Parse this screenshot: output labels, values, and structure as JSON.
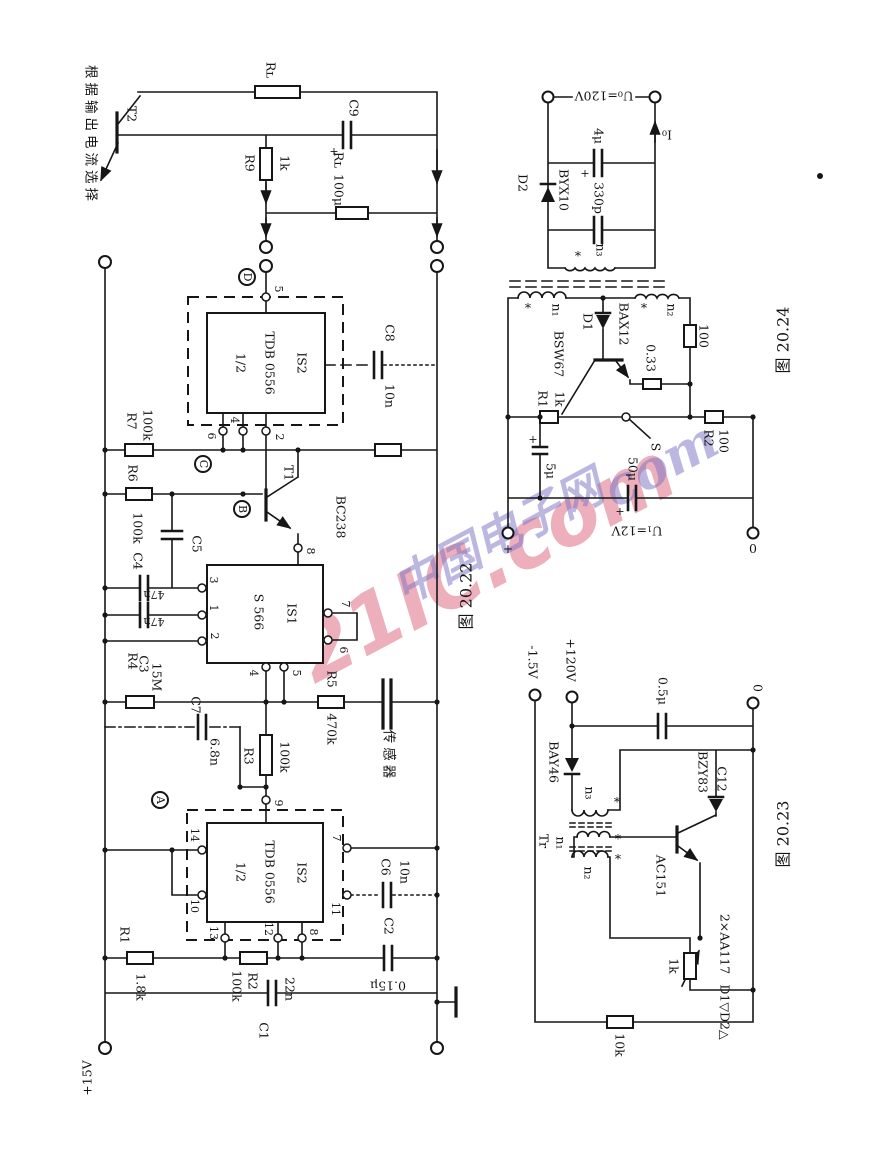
{
  "colors": {
    "ink": "#161616",
    "wm_pink": "#d6506b",
    "wm_blue": "#7a72c4"
  },
  "sym": {
    "star": "*",
    "plus": "+"
  },
  "wm": {
    "big": "21IC.com",
    "cn": "中国电子网",
    "script": "com"
  },
  "c22": {
    "caption": "图 20.22",
    "note": "根据输出电流选择",
    "t2": "T2",
    "rl1": "Rʟ",
    "r9": "R9",
    "r9v": "1k",
    "c9": "C9",
    "c9v": "100μ",
    "rl2": "Rʟ",
    "node_d": "D",
    "node_c": "C",
    "node_b": "B",
    "node_a": "A",
    "is2a_half": "1/2",
    "is2a_name": "TDB 0556",
    "is2a_id": "IS2",
    "p5": "5",
    "p6": "6",
    "p4": "4",
    "p2": "2",
    "c8": "C8",
    "c8v": "10n",
    "r7": "R7",
    "r7v": "100k",
    "r6": "R6",
    "r6v": "100k",
    "r8": "R8",
    "r8v": "100k",
    "c5": "C5",
    "t1": "T1",
    "t1_type": "BC238",
    "p8": "8",
    "is1_name": "S 566",
    "is1_id": "IS1",
    "q3": "3",
    "q1": "1",
    "q2": "2",
    "q7": "7",
    "q6": "6",
    "q4": "4",
    "q5": "5",
    "c4": "C4",
    "c4v": "47n",
    "c3": "C3",
    "c3v": "47n",
    "r4": "R4",
    "r4v": "15M",
    "c7": "C7",
    "c7v": "6.8n",
    "r3": "R3",
    "r3v": "100k",
    "p9": "9",
    "r5": "R5",
    "r5v": "470k",
    "sensor": "传感器",
    "is2b_half": "1/2",
    "is2b_name": "TDB 0556",
    "is2b_id": "IS2",
    "p14": "14",
    "p10": "10",
    "p13": "13",
    "p12": "12",
    "p8b": "8",
    "p7": "7",
    "p11": "11",
    "c6": "C6",
    "c6v": "10n",
    "r1": "R1",
    "r1v": "1.8k",
    "r2": "R2",
    "r2v": "100k",
    "c1": "C1",
    "c1v": "22n",
    "c2": "C2",
    "c2v": "0.15μ",
    "supply": "+15V"
  },
  "c24": {
    "caption": "图 20.24",
    "vout": "U₀=120V",
    "iout": "I₀",
    "d2": "D2",
    "d2_type": "BYX10",
    "cf": "4μ",
    "cp": "330p",
    "n1": "n₁",
    "n2": "n₂",
    "n3": "n₃",
    "d1": "D1",
    "d1_type": "BAX12",
    "q": "BSW67",
    "re": "0.33",
    "rw": "100",
    "r1": "R1",
    "r1v": "1k",
    "sw": "S",
    "r2": "R2",
    "r2v": "100",
    "c1": "5μ",
    "c2": "50μ",
    "vin": "U₁=12V",
    "zero": "0"
  },
  "c23": {
    "caption": "图 20.23",
    "vneg": "-1.5V",
    "vpos": "+120V",
    "zero": "0",
    "cin": "0.5μ",
    "d": "BAY46",
    "tr": "Tr",
    "n1": "n₁",
    "n2": "n₂",
    "n3": "n₃",
    "zd": "BZY83",
    "zd2": "C12",
    "q": "AC151",
    "pot": "1k",
    "r": "10k",
    "dpair": "D1▽D2△",
    "dpair_type": "2×AA117"
  }
}
